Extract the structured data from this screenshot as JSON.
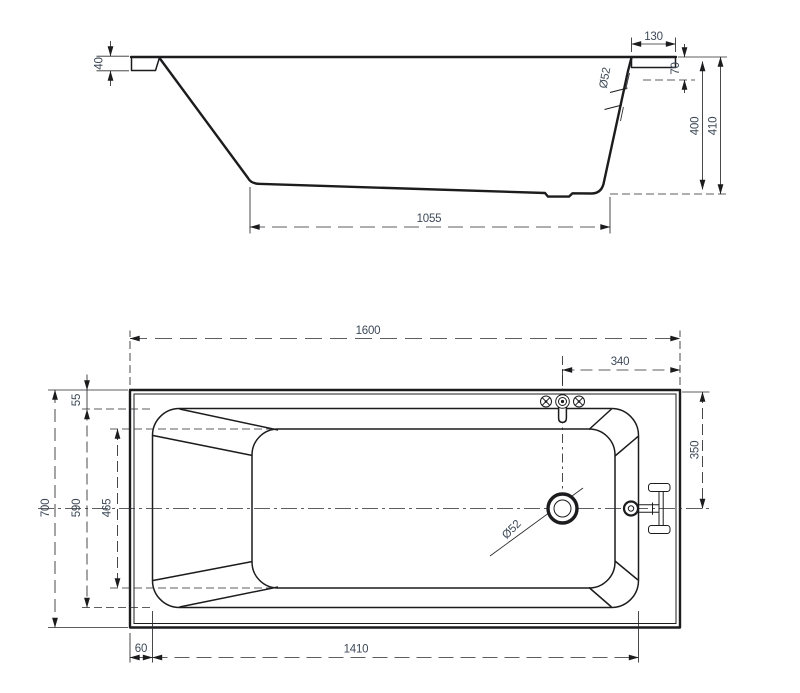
{
  "drawing": {
    "subject": "bathtub-technical-drawing",
    "background": "#ffffff",
    "line_color": "#1c1c1e",
    "dim_text_color": "#3d4957"
  },
  "side_view": {
    "label": "side-elevation",
    "dims": {
      "lip_height": "40",
      "end_rim_width": "130",
      "overflow_diameter": "Ø52",
      "rim_skirt_height": "70",
      "inner_depth": "400",
      "total_height": "410",
      "base_length": "1055"
    }
  },
  "plan_view": {
    "label": "top-plan",
    "dims": {
      "total_length": "1600",
      "faucet_offset": "340",
      "head_rim_margin": "55",
      "total_width": "700",
      "inner_width": "590",
      "base_width": "465",
      "overflow_offset": "350",
      "drain_diameter": "Ø52",
      "inner_length": "1410",
      "side_rim_margin": "60"
    }
  }
}
